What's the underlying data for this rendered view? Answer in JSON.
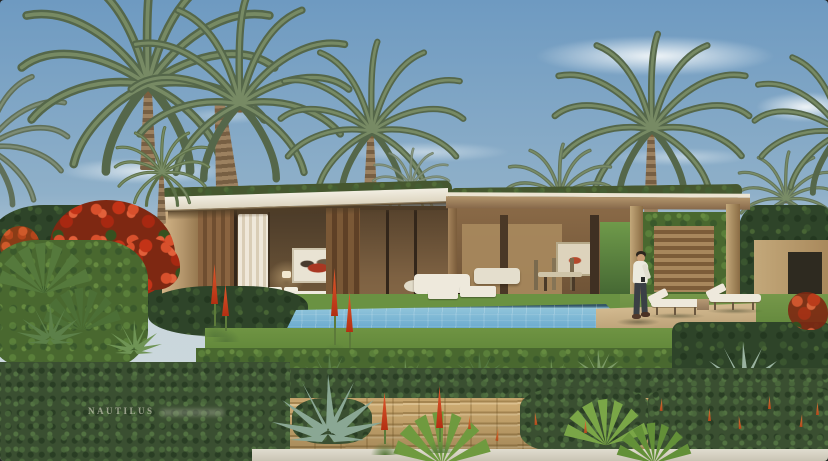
{
  "scene": {
    "subject": "villa-pool-garden-architectural-rendering",
    "watermark": "NAUTILUS",
    "elements": [
      "sky",
      "clouds",
      "date-palm-trees",
      "green-roof-villa",
      "bedroom-wing",
      "open-living-area",
      "pergola",
      "swimming-pool",
      "infinity-edge",
      "lawn",
      "sun-deck",
      "lounge-chairs",
      "standing-person",
      "red-flowering-shrub",
      "agave-plants",
      "aloe-flower-spikes",
      "stone-block-wall",
      "ivy",
      "garden-path"
    ]
  },
  "colors": {
    "sky_top": "#6e9ac1",
    "sky_mid": "#8fb0c9",
    "sky_horizon": "#c9d6dc",
    "frond_dark": "#55674a",
    "frond_light": "#7e9169",
    "trunk_light": "#9c8160",
    "trunk_dark": "#775f43",
    "roof_green": "#46572f",
    "fascia": "#f2eee2",
    "wall_light": "#d3b587",
    "wall_mid": "#b2946a",
    "wall_dark": "#8a6c44",
    "wood_dark": "#4a3826",
    "interior_warm": "#7d6142",
    "curtain": "#efe8da",
    "pool_light": "#8fc4da",
    "pool_mid": "#6fadd0",
    "pool_deep": "#4f8fb4",
    "lawn_light": "#76984a",
    "lawn_dark": "#557c32",
    "deck": "#d2b98f",
    "lounger": "#eee9dc",
    "hedge_dark": "#2e4429",
    "hedge_mid": "#49682f",
    "agave_green": "#5c8049",
    "agave_blue": "#8fae9a",
    "flower_red": "#c53218",
    "aloe_red": "#b32f12",
    "brick": "#cdab72",
    "path": "#ddd8ca",
    "shirt": "#eceade",
    "pants": "#3a3f45",
    "skin": "#c79b72"
  }
}
